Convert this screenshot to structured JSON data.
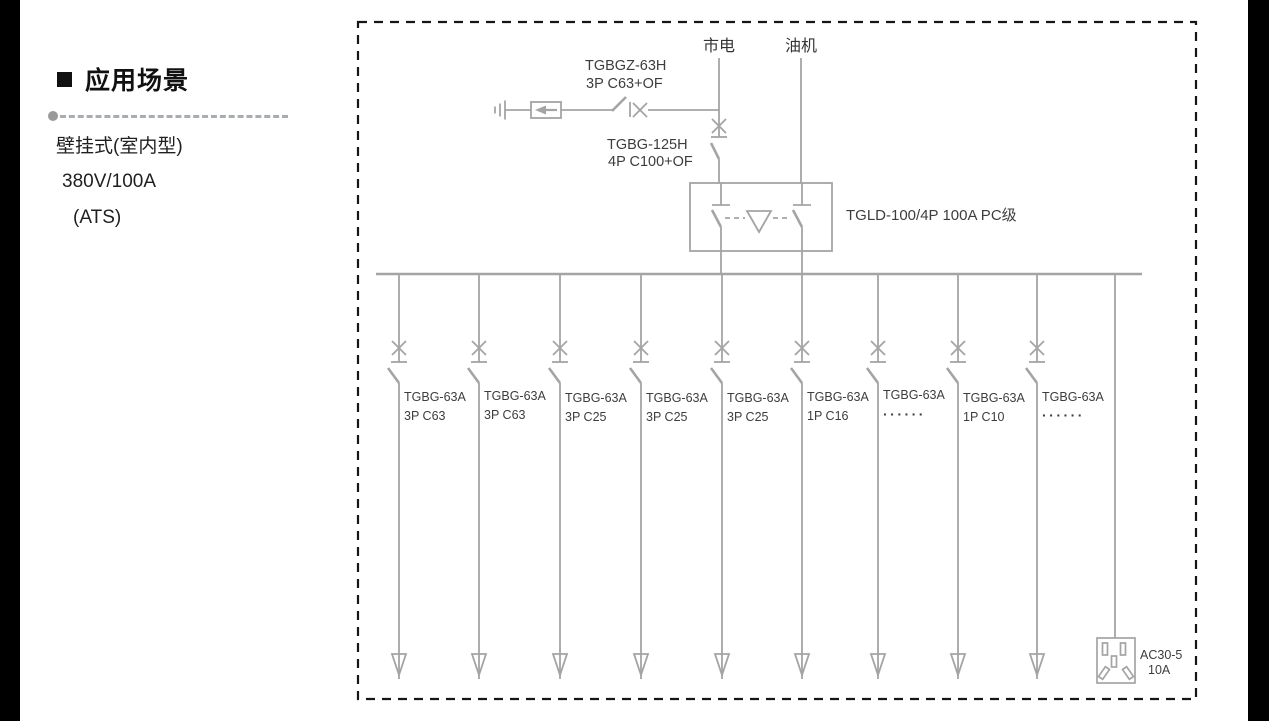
{
  "left_panel": {
    "heading": "应用场景",
    "lines": [
      "壁挂式(室内型)",
      "380V/100A",
      "(ATS)"
    ]
  },
  "diagram": {
    "mains_label": "市电",
    "generator_label": "油机",
    "spd_breaker": {
      "model": "TGBGZ-63H",
      "spec": "3P C63+OF"
    },
    "main_breaker": {
      "model": "TGBG-125H",
      "spec": "4P C100+OF"
    },
    "ats_label": "TGLD-100/4P 100A PC级",
    "branches": [
      {
        "model": "TGBG-63A",
        "spec": "3P C63"
      },
      {
        "model": "TGBG-63A",
        "spec": "3P C63"
      },
      {
        "model": "TGBG-63A",
        "spec": "3P C25"
      },
      {
        "model": "TGBG-63A",
        "spec": "3P C25"
      },
      {
        "model": "TGBG-63A",
        "spec": "3P C25"
      },
      {
        "model": "TGBG-63A",
        "spec": "1P C16"
      },
      {
        "model": "TGBG-63A",
        "spec": "······"
      },
      {
        "model": "TGBG-63A",
        "spec": "1P C10"
      },
      {
        "model": "TGBG-63A",
        "spec": "······"
      }
    ],
    "socket": {
      "model": "AC30-5",
      "rating": "10A"
    }
  },
  "colors": {
    "line": "#a4a4a4",
    "text": "#3d3d3d",
    "border": "#161616"
  }
}
